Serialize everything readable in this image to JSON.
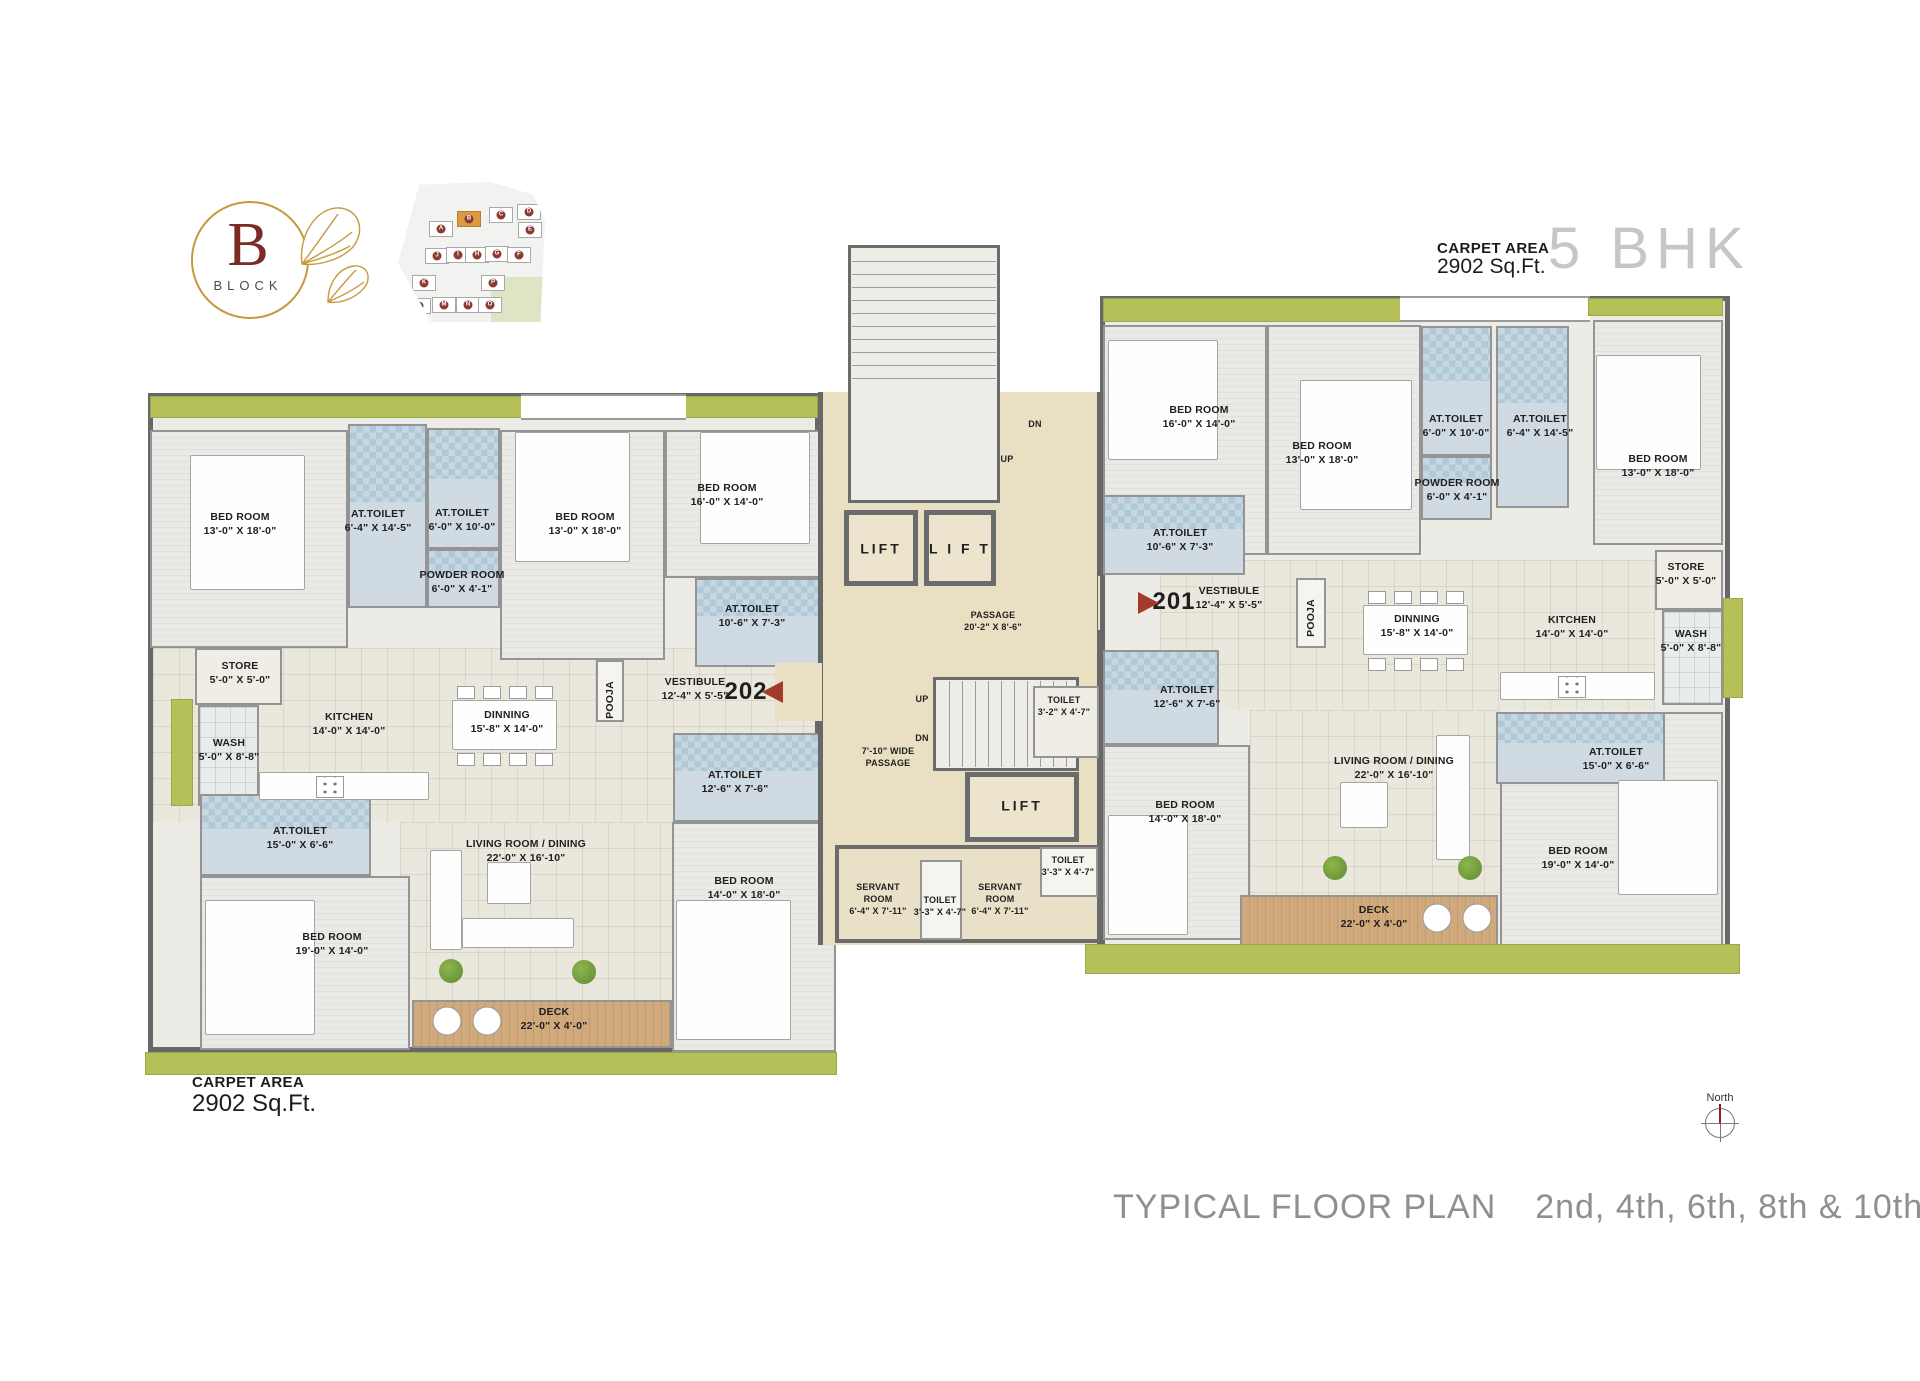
{
  "logo": {
    "letter": "B",
    "word": "BLOCK"
  },
  "header": {
    "carpet_area_label": "CARPET AREA",
    "carpet_area_value": "2902 Sq.Ft.",
    "unit_type": "5 BHK"
  },
  "footer": {
    "carpet_area_label": "CARPET AREA",
    "carpet_area_value": "2902 Sq.Ft.",
    "plan_title": "TYPICAL FLOOR PLAN",
    "plan_floors": "2nd, 4th, 6th, 8th & 10th",
    "north_label": "North"
  },
  "units": [
    {
      "number": "202",
      "carpet_area": "2902 Sq.Ft."
    },
    {
      "number": "201",
      "carpet_area": "2902 Sq.Ft."
    }
  ],
  "site_map": {
    "highlight": "B",
    "blocks": [
      {
        "id": "A",
        "x": 31,
        "y": 39
      },
      {
        "id": "B",
        "x": 59,
        "y": 29
      },
      {
        "id": "C",
        "x": 91,
        "y": 25
      },
      {
        "id": "D",
        "x": 119,
        "y": 22
      },
      {
        "id": "E",
        "x": 120,
        "y": 40
      },
      {
        "id": "J",
        "x": 27,
        "y": 66
      },
      {
        "id": "I",
        "x": 48,
        "y": 65
      },
      {
        "id": "H",
        "x": 67,
        "y": 65
      },
      {
        "id": "G",
        "x": 87,
        "y": 64
      },
      {
        "id": "F",
        "x": 109,
        "y": 65
      },
      {
        "id": "K",
        "x": 14,
        "y": 93
      },
      {
        "id": "P",
        "x": 83,
        "y": 93
      },
      {
        "id": "L",
        "x": 9,
        "y": 116
      },
      {
        "id": "M",
        "x": 34,
        "y": 115
      },
      {
        "id": "N",
        "x": 58,
        "y": 115
      },
      {
        "id": "O",
        "x": 80,
        "y": 115
      }
    ]
  },
  "colors": {
    "green": "#b5c158",
    "deck": "#cda87b",
    "toilet": "#cfdae2",
    "passage": "#e9e0c4",
    "wall": "#686868",
    "accent_red": "#a23b28",
    "logo_gold": "#c59a3f",
    "logo_maroon": "#7b2b26"
  },
  "plan_labels": [
    {
      "id": "label-bedroom-202-1",
      "lines": [
        "BED ROOM",
        "13'-0\" X 18'-0\""
      ],
      "x": 240,
      "y": 524
    },
    {
      "id": "label-at-toilet-202-1",
      "lines": [
        "AT.TOILET",
        "6'-4\" X 14'-5\""
      ],
      "x": 378,
      "y": 521
    },
    {
      "id": "label-at-toilet-202-2",
      "lines": [
        "AT.TOILET",
        "6'-0\" X 10'-0\""
      ],
      "x": 462,
      "y": 520
    },
    {
      "id": "label-powder-room-202",
      "lines": [
        "POWDER ROOM",
        "6'-0\" X 4'-1\""
      ],
      "x": 462,
      "y": 582
    },
    {
      "id": "label-bedroom-202-2",
      "lines": [
        "BED ROOM",
        "13'-0\" X 18'-0\""
      ],
      "x": 585,
      "y": 524
    },
    {
      "id": "label-bedroom-202-3",
      "lines": [
        "BED ROOM",
        "16'-0\" X 14'-0\""
      ],
      "x": 727,
      "y": 495
    },
    {
      "id": "label-at-toilet-202-3",
      "lines": [
        "AT.TOILET",
        "10'-6\" X 7'-3\""
      ],
      "x": 752,
      "y": 616
    },
    {
      "id": "label-store-202",
      "lines": [
        "STORE",
        "5'-0\" X 5'-0\""
      ],
      "x": 240,
      "y": 673
    },
    {
      "id": "label-wash-202",
      "lines": [
        "WASH",
        "5'-0\" X 8'-8\""
      ],
      "x": 229,
      "y": 750
    },
    {
      "id": "label-kitchen-202",
      "lines": [
        "KITCHEN",
        "14'-0\" X 14'-0\""
      ],
      "x": 349,
      "y": 724
    },
    {
      "id": "label-dinning-202",
      "lines": [
        "DINNING",
        "15'-8\" X 14'-0\""
      ],
      "x": 507,
      "y": 722
    },
    {
      "id": "label-pooja-202",
      "lines": [
        "POOJA"
      ],
      "x": 610,
      "y": 700,
      "cls": "vert"
    },
    {
      "id": "label-vestibule-202",
      "lines": [
        "VESTIBULE",
        "12'-4\" X 5'-5\""
      ],
      "x": 695,
      "y": 689
    },
    {
      "id": "label-unit-202",
      "lines": [
        "202"
      ],
      "x": 746,
      "y": 692,
      "cls": "unitnum"
    },
    {
      "id": "label-at-toilet-202-4",
      "lines": [
        "AT.TOILET",
        "12'-6\" X 7'-6\""
      ],
      "x": 735,
      "y": 782
    },
    {
      "id": "label-at-toilet-202-5",
      "lines": [
        "AT.TOILET",
        "15'-0\" X 6'-6\""
      ],
      "x": 300,
      "y": 838
    },
    {
      "id": "label-bedroom-202-4",
      "lines": [
        "BED ROOM",
        "19'-0\" X 14'-0\""
      ],
      "x": 332,
      "y": 944
    },
    {
      "id": "label-living-202",
      "lines": [
        "LIVING ROOM / DINING",
        "22'-0\" X 16'-10\""
      ],
      "x": 526,
      "y": 851
    },
    {
      "id": "label-deck-202",
      "lines": [
        "DECK",
        "22'-0\" X 4'-0\""
      ],
      "x": 554,
      "y": 1019
    },
    {
      "id": "label-bedroom-202-5",
      "lines": [
        "BED ROOM",
        "14'-0\" X 18'-0\""
      ],
      "x": 744,
      "y": 888
    },
    {
      "id": "label-stairs-dn-top",
      "lines": [
        "DN"
      ],
      "x": 1035,
      "y": 424,
      "cls": "tiny9"
    },
    {
      "id": "label-stairs-up-top",
      "lines": [
        "UP"
      ],
      "x": 1007,
      "y": 459,
      "cls": "tiny9"
    },
    {
      "id": "label-lift-1",
      "lines": [
        "LIFT"
      ],
      "x": 881,
      "y": 549,
      "cls": "lbl-lift"
    },
    {
      "id": "label-lift-2",
      "lines": [
        "L I F T"
      ],
      "x": 960,
      "y": 549,
      "cls": "lbl-lift"
    },
    {
      "id": "label-passage",
      "lines": [
        "PASSAGE",
        "20'-2\" X 8'-6\""
      ],
      "x": 993,
      "y": 621,
      "cls": "tiny9"
    },
    {
      "id": "label-stairs-up-low",
      "lines": [
        "UP"
      ],
      "x": 922,
      "y": 699,
      "cls": "tiny9"
    },
    {
      "id": "label-stairs-dn-low",
      "lines": [
        "DN"
      ],
      "x": 922,
      "y": 738,
      "cls": "tiny9"
    },
    {
      "id": "label-wide-passage",
      "lines": [
        "7'-10\" WIDE",
        "PASSAGE"
      ],
      "x": 888,
      "y": 757,
      "cls": "tiny9"
    },
    {
      "id": "label-lift-3",
      "lines": [
        "LIFT"
      ],
      "x": 1022,
      "y": 806,
      "cls": "lbl-lift"
    },
    {
      "id": "label-toilet-core",
      "lines": [
        "TOILET",
        "3'-2\" X 4'-7\""
      ],
      "x": 1064,
      "y": 706,
      "cls": "tiny9"
    },
    {
      "id": "label-servant-room-1",
      "lines": [
        "SERVANT",
        "ROOM",
        "6'-4\" X 7'-11\""
      ],
      "x": 878,
      "y": 899,
      "cls": "tiny9"
    },
    {
      "id": "label-toilet-servant-1",
      "lines": [
        "TOILET",
        "3'-3\" X 4'-7\""
      ],
      "x": 940,
      "y": 906,
      "cls": "tiny9"
    },
    {
      "id": "label-servant-room-2",
      "lines": [
        "SERVANT",
        "ROOM",
        "6'-4\" X 7'-11\""
      ],
      "x": 1000,
      "y": 899,
      "cls": "tiny9"
    },
    {
      "id": "label-toilet-servant-2",
      "lines": [
        "TOILET",
        "3'-3\" X 4'-7\""
      ],
      "x": 1068,
      "y": 866,
      "cls": "tiny9"
    },
    {
      "id": "label-bedroom-201-1",
      "lines": [
        "BED ROOM",
        "16'-0\" X 14'-0\""
      ],
      "x": 1199,
      "y": 417
    },
    {
      "id": "label-bedroom-201-2",
      "lines": [
        "BED ROOM",
        "13'-0\" X 18'-0\""
      ],
      "x": 1322,
      "y": 453
    },
    {
      "id": "label-at-toilet-201-1",
      "lines": [
        "AT.TOILET",
        "6'-0\" X 10'-0\""
      ],
      "x": 1456,
      "y": 426
    },
    {
      "id": "label-powder-room-201",
      "lines": [
        "POWDER ROOM",
        "6'-0\" X 4'-1\""
      ],
      "x": 1457,
      "y": 490
    },
    {
      "id": "label-at-toilet-201-2",
      "lines": [
        "AT.TOILET",
        "6'-4\" X 14'-5\""
      ],
      "x": 1540,
      "y": 426
    },
    {
      "id": "label-bedroom-201-3",
      "lines": [
        "BED ROOM",
        "13'-0\" X 18'-0\""
      ],
      "x": 1658,
      "y": 466
    },
    {
      "id": "label-at-toilet-201-3",
      "lines": [
        "AT.TOILET",
        "10'-6\" X 7'-3\""
      ],
      "x": 1180,
      "y": 540
    },
    {
      "id": "label-store-201",
      "lines": [
        "STORE",
        "5'-0\" X 5'-0\""
      ],
      "x": 1686,
      "y": 574
    },
    {
      "id": "label-wash-201",
      "lines": [
        "WASH",
        "5'-0\" X 8'-8\""
      ],
      "x": 1691,
      "y": 641
    },
    {
      "id": "label-unit-201",
      "lines": [
        "201"
      ],
      "x": 1174,
      "y": 602,
      "cls": "unitnum"
    },
    {
      "id": "label-vestibule-201",
      "lines": [
        "VESTIBULE",
        "12'-4\" X 5'-5\""
      ],
      "x": 1229,
      "y": 598
    },
    {
      "id": "label-pooja-201",
      "lines": [
        "POOJA"
      ],
      "x": 1311,
      "y": 618,
      "cls": "vert"
    },
    {
      "id": "label-dinning-201",
      "lines": [
        "DINNING",
        "15'-8\" X 14'-0\""
      ],
      "x": 1417,
      "y": 626
    },
    {
      "id": "label-kitchen-201",
      "lines": [
        "KITCHEN",
        "14'-0\" X 14'-0\""
      ],
      "x": 1572,
      "y": 627
    },
    {
      "id": "label-at-toilet-201-4",
      "lines": [
        "AT.TOILET",
        "12'-6\" X 7'-6\""
      ],
      "x": 1187,
      "y": 697
    },
    {
      "id": "label-bedroom-201-4",
      "lines": [
        "BED ROOM",
        "14'-0\" X 18'-0\""
      ],
      "x": 1185,
      "y": 812
    },
    {
      "id": "label-living-201",
      "lines": [
        "LIVING ROOM / DINING",
        "22'-0\" X 16'-10\""
      ],
      "x": 1394,
      "y": 768
    },
    {
      "id": "label-at-toilet-201-5",
      "lines": [
        "AT.TOILET",
        "15'-0\" X 6'-6\""
      ],
      "x": 1616,
      "y": 759
    },
    {
      "id": "label-bedroom-201-5",
      "lines": [
        "BED ROOM",
        "19'-0\" X 14'-0\""
      ],
      "x": 1578,
      "y": 858
    },
    {
      "id": "label-deck-201",
      "lines": [
        "DECK",
        "22'-0\" X 4'-0\""
      ],
      "x": 1374,
      "y": 917
    }
  ]
}
